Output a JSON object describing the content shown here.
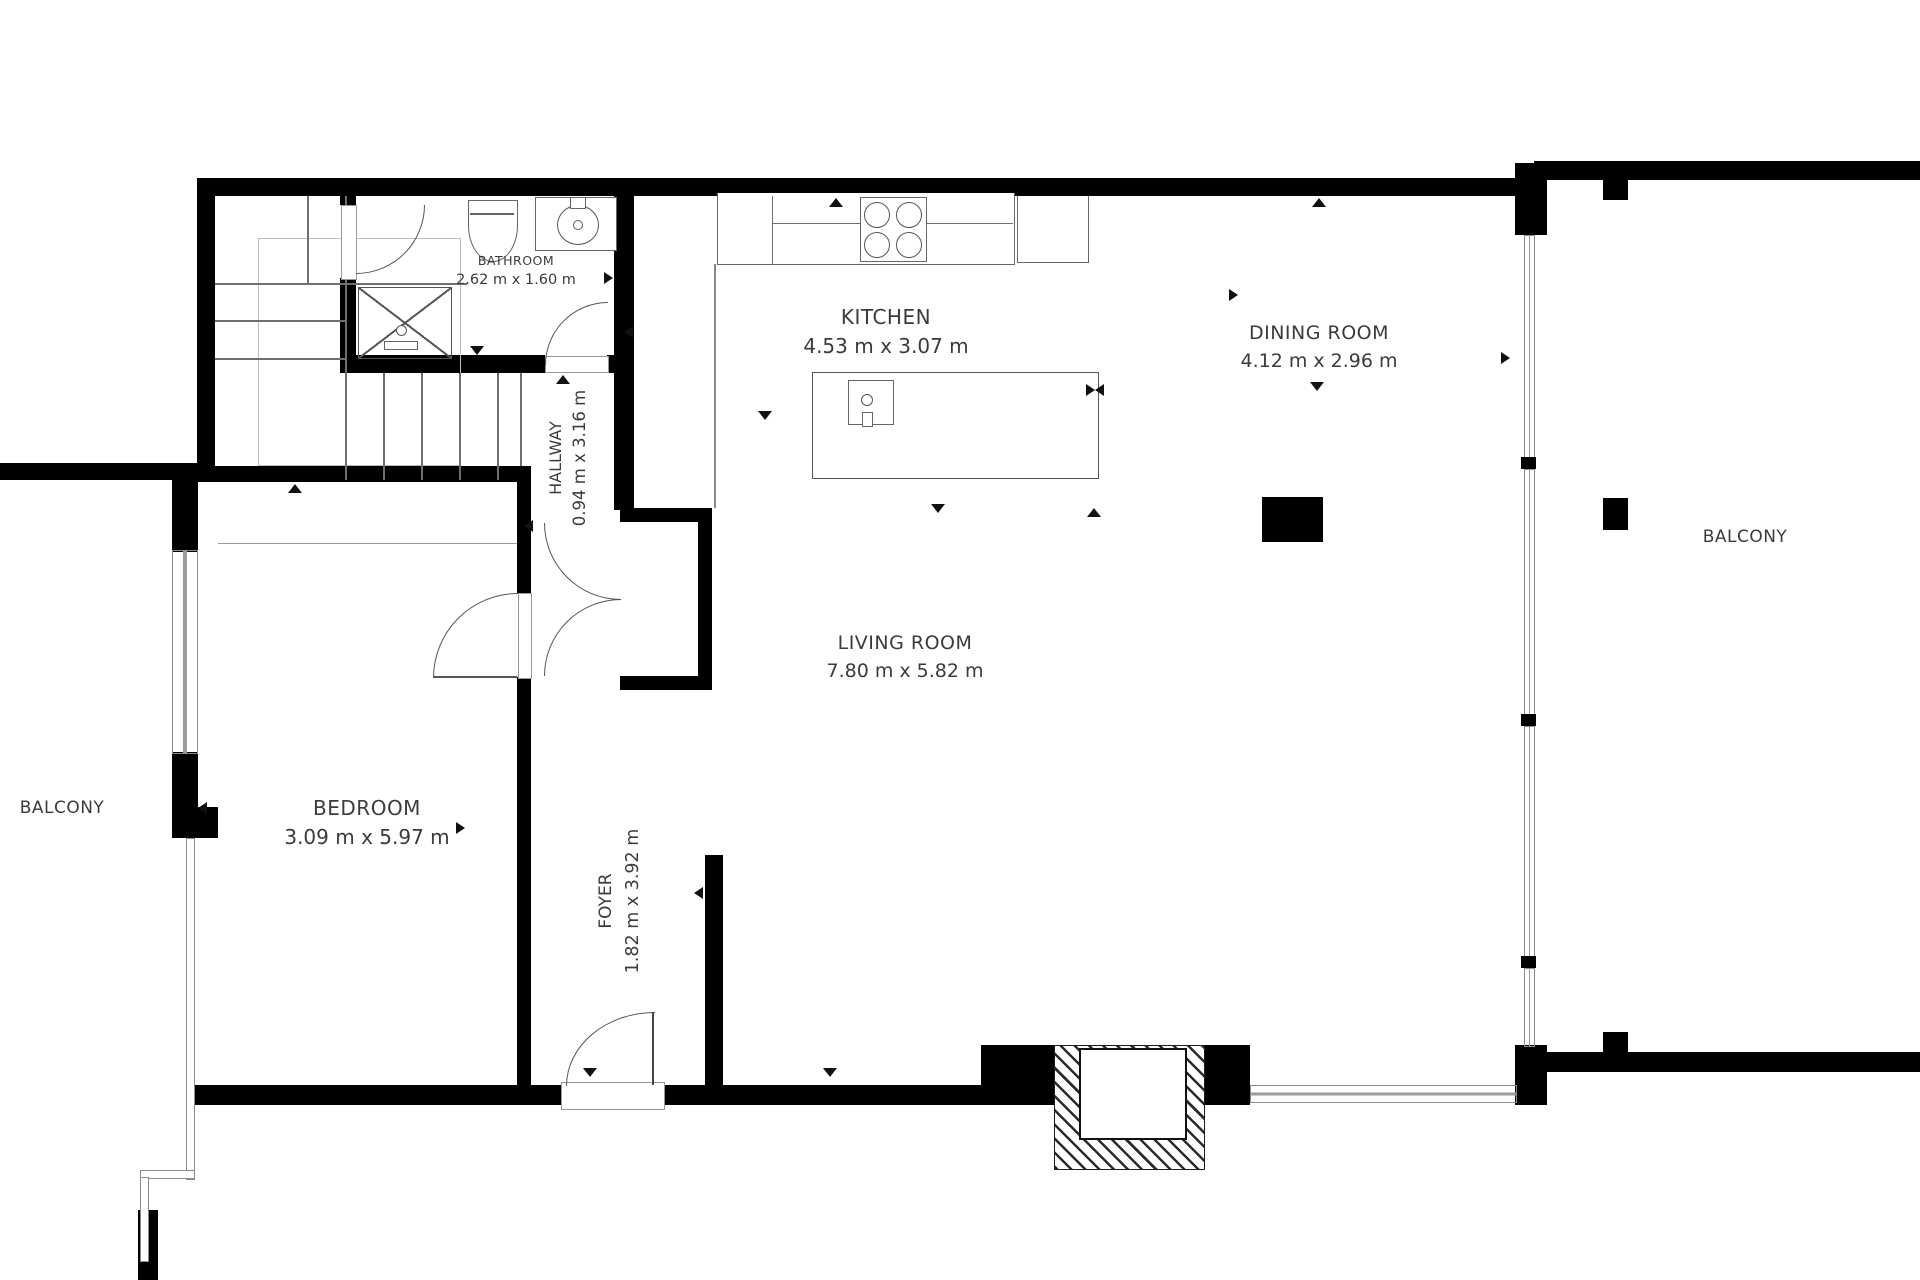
{
  "rooms": {
    "bathroom": {
      "name": "BATHROOM",
      "dims": "2.62 m x 1.60 m"
    },
    "kitchen": {
      "name": "KITCHEN",
      "dims": "4.53 m x 3.07 m"
    },
    "dining": {
      "name": "DINING ROOM",
      "dims": "4.12 m x 2.96 m"
    },
    "hallway": {
      "name": "HALLWAY",
      "dims": "0.94 m x 3.16 m"
    },
    "bedroom": {
      "name": "BEDROOM",
      "dims": "3.09 m x 5.97 m"
    },
    "foyer": {
      "name": "FOYER",
      "dims": "1.82 m x 3.92 m"
    },
    "living": {
      "name": "LIVING ROOM",
      "dims": "7.80 m x 5.82 m"
    },
    "balcony_left": {
      "name": "BALCONY"
    },
    "balcony_right": {
      "name": "BALCONY"
    }
  },
  "colors": {
    "wall": "#000000",
    "text": "#3b3b3b",
    "line": "#6f6f6f"
  }
}
